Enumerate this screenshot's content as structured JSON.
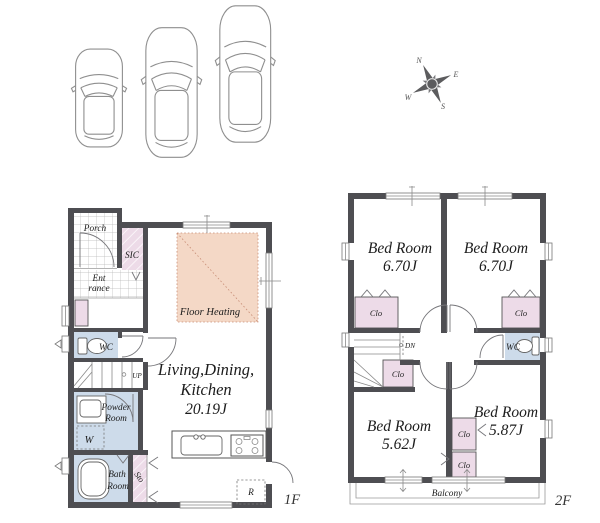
{
  "palette": {
    "wall": "#4e4e52",
    "line": "#76767a",
    "room_blue": "#cddbea",
    "room_pink": "#eddbe8",
    "floor_heating": "#f4d8c6",
    "heat_line": "#c98f78",
    "text": "#1c1c1c",
    "car_line": "#8f8f8f"
  },
  "compass": {
    "n": "N",
    "e": "E",
    "s": "S",
    "w": "W"
  },
  "f1": {
    "floor_label": "1F",
    "porch": "Porch",
    "sic": "SIC",
    "entrance1": "Ent",
    "entrance2": "rance",
    "wc": "WC",
    "up": "UP",
    "powder1": "Powder",
    "powder2": "Room",
    "washer": "W",
    "bath1": "Bath",
    "bath2": "Room",
    "sto": "Sto",
    "floor_heating": "Floor Heating",
    "ldk1": "Living,Dining,",
    "ldk2": "Kitchen",
    "ldk3": "20.19J",
    "fridge": "R"
  },
  "f2": {
    "floor_label": "2F",
    "bedroom": "Bed Room",
    "bed1_size": "6.70J",
    "bed2_size": "6.70J",
    "bed3_size": "5.62J",
    "bed4_size": "5.87J",
    "clo": "Clo",
    "wc": "WC",
    "dn": "DN",
    "balcony": "Balcony"
  }
}
